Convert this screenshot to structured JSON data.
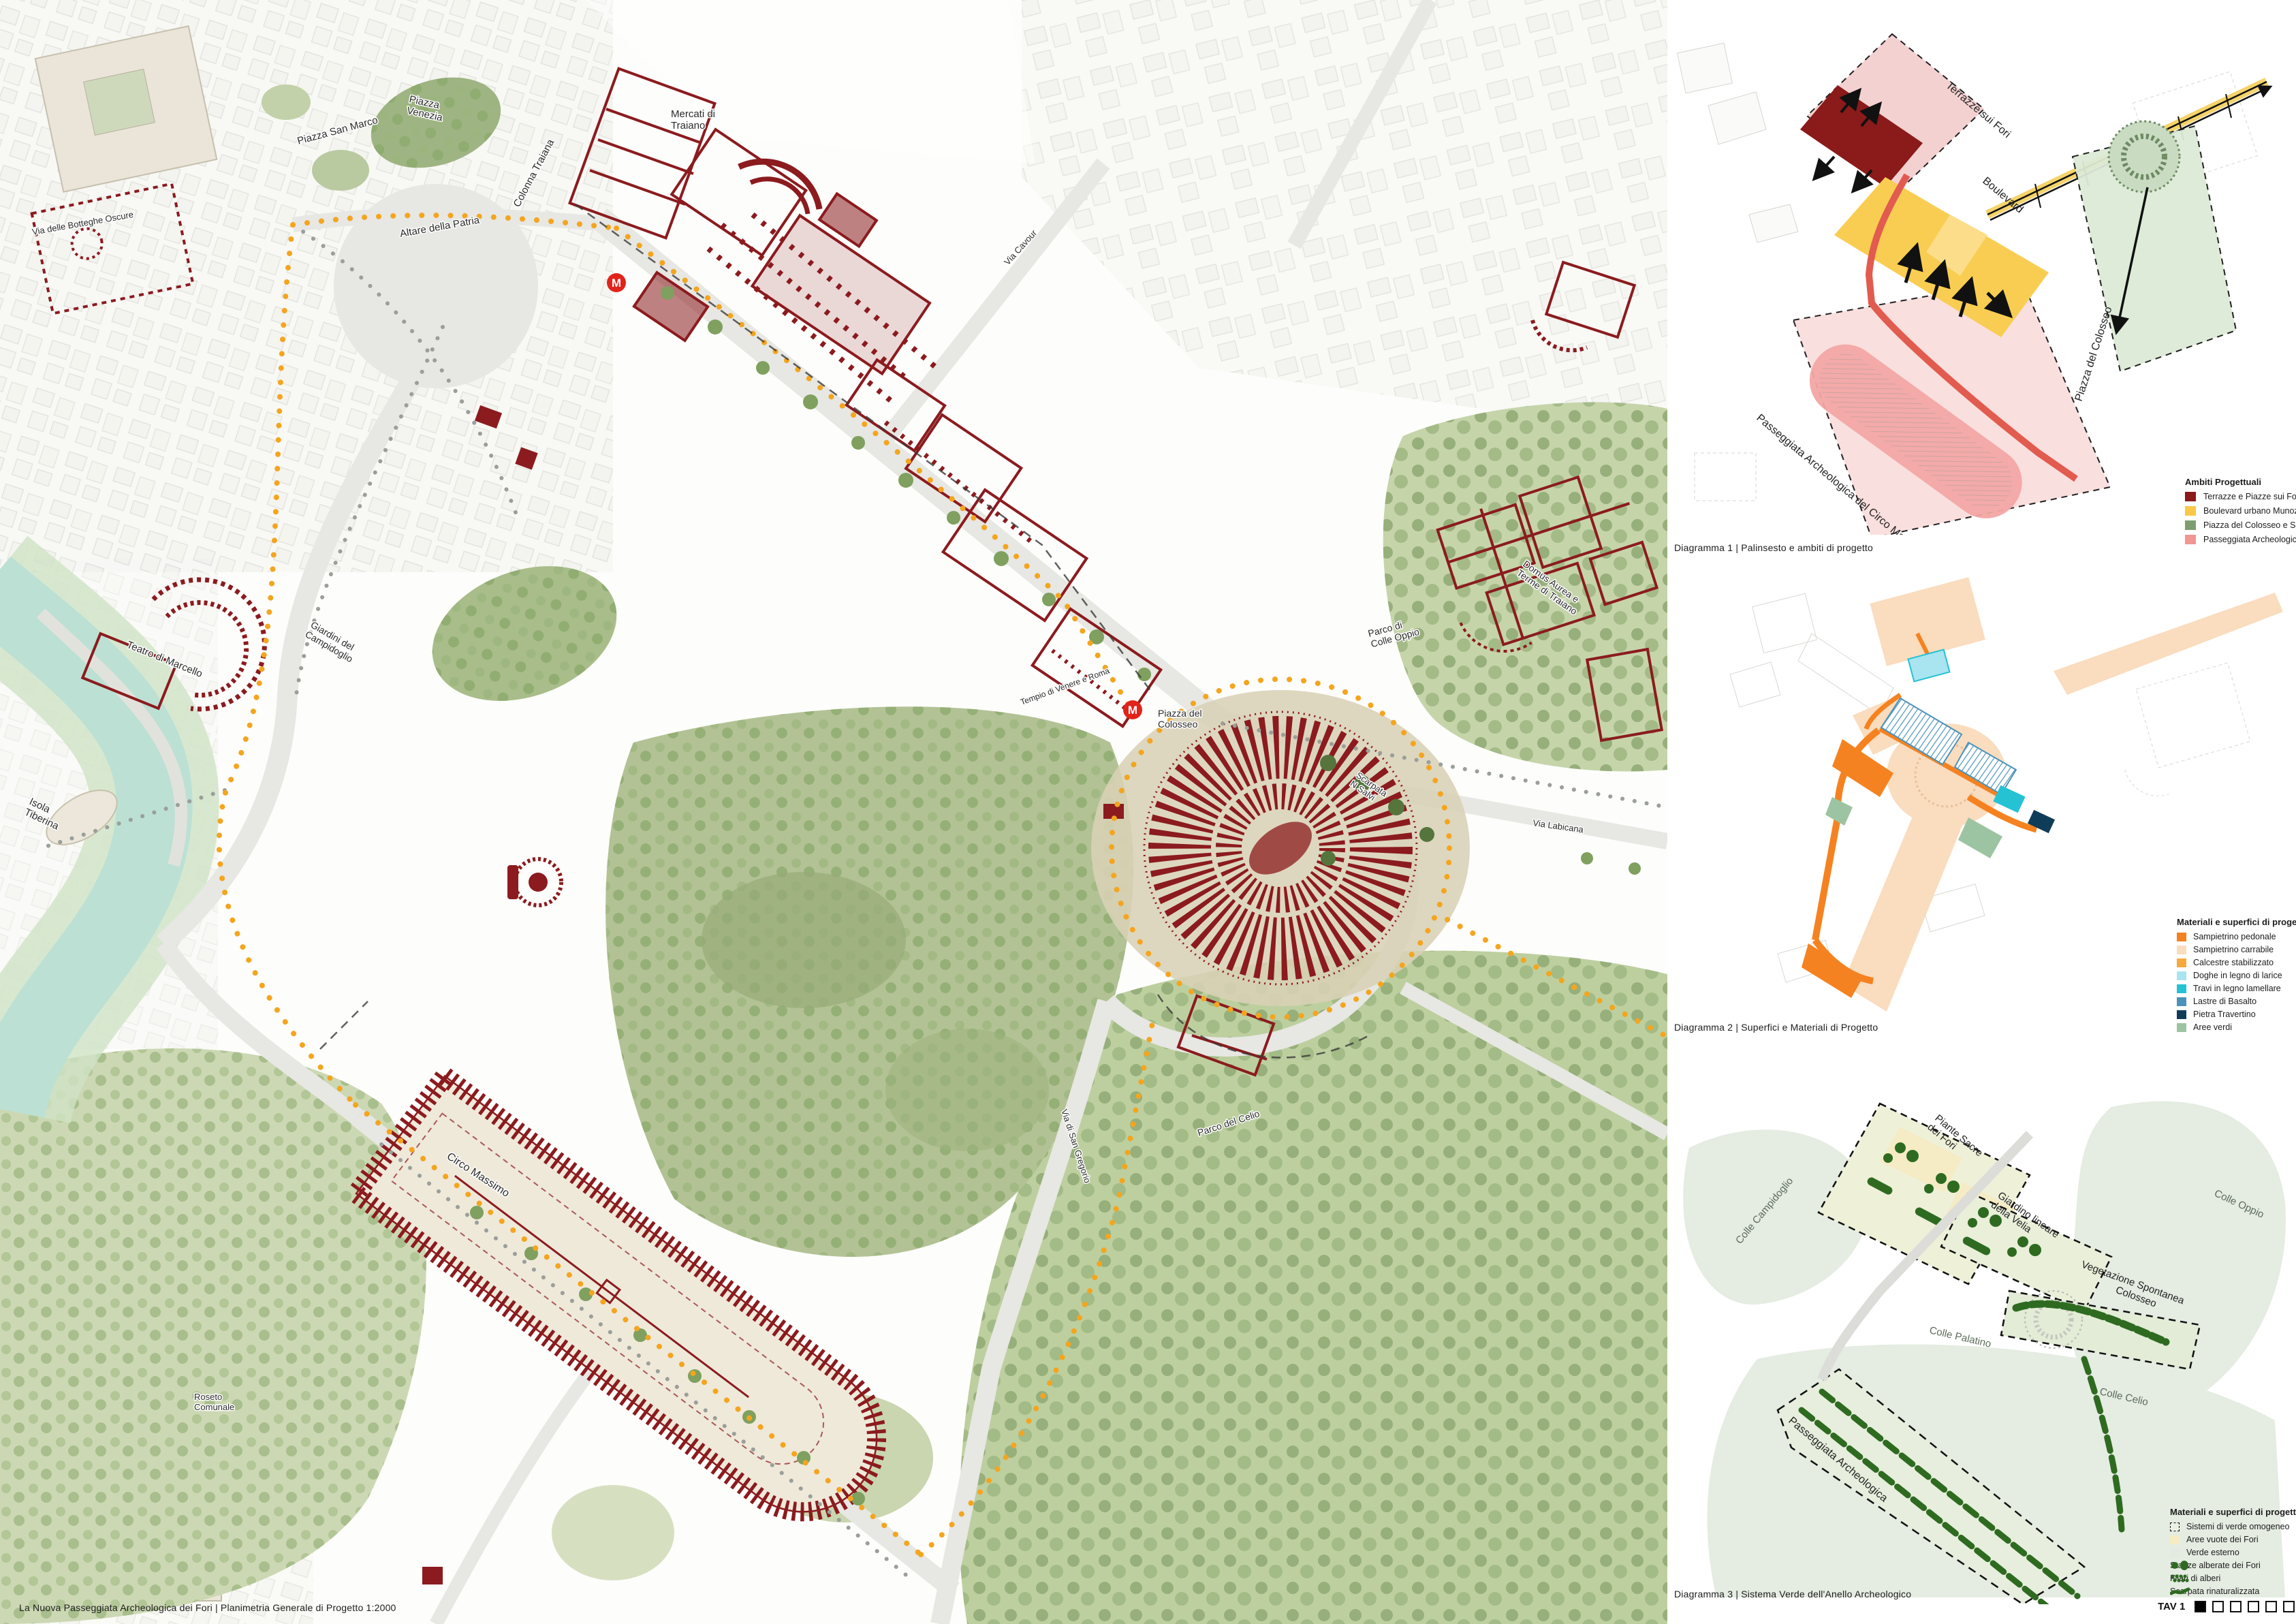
{
  "board": {
    "title_caption": "La Nuova Passeggiata Archeologica dei Fori | Planimetria Generale di Progetto 1:2000",
    "tav": {
      "label": "TAV 1",
      "total_tiles": 6,
      "active_tile": 1
    }
  },
  "palette": {
    "archaeology_red": "#8B1B1E",
    "route_yellow": "#F4A51F",
    "river_teal": "#BCE0D4",
    "park_green": "#C3D2A6",
    "road_gray": "#E7E7E4",
    "metro_red": "#E2231A"
  },
  "main_map": {
    "metro_label": "M",
    "labels": [
      {
        "lines": [
          "Piazza",
          "Venezia"
        ]
      },
      {
        "lines": [
          "Piazza San Marco"
        ]
      },
      {
        "lines": [
          "Altare della Patria"
        ]
      },
      {
        "lines": [
          "Colonna Traiana"
        ]
      },
      {
        "lines": [
          "Mercati di",
          "Traiano"
        ]
      },
      {
        "lines": [
          "Via delle Botteghe Oscure"
        ]
      },
      {
        "lines": [
          "Teatro di Marcello"
        ]
      },
      {
        "lines": [
          "Isola",
          "Tiberina"
        ]
      },
      {
        "lines": [
          "Giardini del",
          "Campidoglio"
        ]
      },
      {
        "lines": [
          "Domus Aurea e",
          "Terme di Traiano"
        ]
      },
      {
        "lines": [
          "Parco di",
          "Colle Oppio"
        ]
      },
      {
        "lines": [
          "Piazza del",
          "Colosseo"
        ]
      },
      {
        "lines": [
          "Scarpata",
          "N Salvi"
        ]
      },
      {
        "lines": [
          "Tempio di Venere e Roma"
        ]
      },
      {
        "lines": [
          "Circo Massimo"
        ]
      },
      {
        "lines": [
          "Via Cavour"
        ]
      },
      {
        "lines": [
          "Via Labicana"
        ]
      },
      {
        "lines": [
          "Via di San Gregorio"
        ]
      },
      {
        "lines": [
          "Parco del Celio"
        ]
      },
      {
        "lines": [
          "Roseto",
          "Comunale"
        ]
      }
    ]
  },
  "diagram1": {
    "caption": "Diagramma 1 | Palinsesto e ambiti di progetto",
    "labels": [
      {
        "text": "Terrazze sui Fori"
      },
      {
        "text": "Boulevard"
      },
      {
        "text": "Piazza del Colosseo"
      },
      {
        "text": "Passeggiata Archeologica del Circo Massimo"
      }
    ],
    "legend": {
      "title": "Ambiti Progettuali",
      "items": [
        {
          "label": "Terrazze e Piazze sui Fori",
          "color": "#8B1A1A"
        },
        {
          "label": "Boulevard urbano Munoz",
          "color": "#F9C848"
        },
        {
          "label": "Piazza del Colosseo e Scarpata",
          "color": "#7E9E72"
        },
        {
          "label": "Passeggiata Archeologica",
          "color": "#F29694"
        }
      ]
    }
  },
  "diagram2": {
    "caption": "Diagramma 2 | Superfici e Materiali di Progetto",
    "legend": {
      "title": "Materiali e superfici di progetto",
      "items": [
        {
          "label": "Sampietrino pedonale",
          "color": "#F58220"
        },
        {
          "label": "Sampietrino carrabile",
          "color": "#FADCBE"
        },
        {
          "label": "Calcestre stabilizzato",
          "color": "#F6A83D"
        },
        {
          "label": "Doghe in legno di larice",
          "color": "#A9E4F1"
        },
        {
          "label": "Travi in legno lamellare",
          "color": "#25C2D3"
        },
        {
          "label": "Lastre di Basalto",
          "color": "#4C92B9"
        },
        {
          "label": "Pietra Travertino",
          "color": "#0F3C59"
        },
        {
          "label": "Aree verdi",
          "color": "#9DC4A2"
        }
      ]
    }
  },
  "diagram3": {
    "caption": "Diagramma 3 | Sistema Verde dell'Anello Archeologico",
    "labels": [
      {
        "lines": [
          "Piante Sacre",
          "dei Fori"
        ]
      },
      {
        "lines": [
          "Giardino lineare",
          "della Velia"
        ]
      },
      {
        "lines": [
          "Vegetazione Spontanea",
          "Colosseo"
        ]
      },
      {
        "lines": [
          "Colle Oppio"
        ]
      },
      {
        "lines": [
          "Colle Campidoglio"
        ]
      },
      {
        "lines": [
          "Colle Palatino"
        ]
      },
      {
        "lines": [
          "Colle Celio"
        ]
      },
      {
        "lines": [
          "Passeggiata Archeologica"
        ]
      }
    ],
    "legend": {
      "title": "Materiali e superfici di progetto",
      "items": [
        {
          "label": "Sistemi di verde omogeneo",
          "color": "#EAF1E2",
          "style": "dashed-box"
        },
        {
          "label": "Aree vuote dei Fori",
          "color": "#F5EBC4",
          "style": "box"
        },
        {
          "label": "Verde esterno",
          "color": "#E3EAE1",
          "style": "box"
        },
        {
          "label": "Stanze alberate dei Fori",
          "color": "#2E6B21",
          "style": "blobs"
        },
        {
          "label": "Filari di alberi",
          "color": "#2E6B21",
          "style": "dots"
        },
        {
          "label": "Scarpata rinaturalizzata",
          "color": "#2E6B21",
          "style": "stroke"
        }
      ]
    }
  }
}
